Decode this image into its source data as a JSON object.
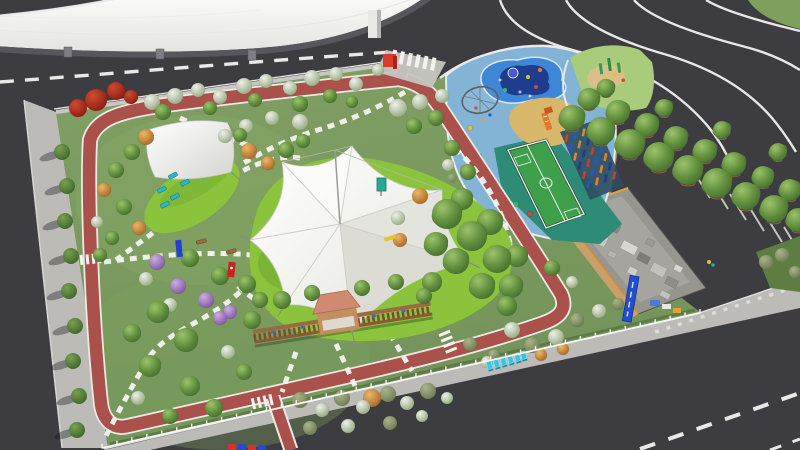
{
  "palette": {
    "asphalt": "#3c3c41",
    "asphalt_light": "#46464b",
    "sidewalk": "#bcbbb7",
    "building_roof": "#f2f2ef",
    "building_shadow": "#56565c",
    "grass_base": "#7a9a5e",
    "lawn_bright": "#8bc43c",
    "track_red": "#a9514a",
    "track_edge": "#eceae6",
    "path_white": "#f4f4f0",
    "canopy_white": "#f4f4f1",
    "playground_pad": "#83b4d6",
    "splash_blue": "#3e86d8",
    "splash_navy": "#1f3d8e",
    "sand": "#d8b76a",
    "court_green": "#3fa04c",
    "court_zone_teal": "#2e8b76",
    "pergola_brown": "#8a5a36",
    "gazebo_roof": "#d08a72",
    "lounger_teal": "#2ab8c8",
    "sign_red": "#d83a2c",
    "sign_blue": "#2050d0",
    "sculpture_cyan": "#33c6e6",
    "fence_white": "#f6f6f3",
    "tree_green": "#55823a",
    "tree_autumn": "#b5742f",
    "tree_bloom": "#a3b690",
    "tree_purple": "#8f68b0",
    "tree_red": "#8c1f12"
  },
  "objects": [
    "curved-roof-building",
    "perimeter-roads",
    "interchange-curves",
    "park-lawn",
    "red-jogging-track",
    "stepping-stone-paths",
    "tensile-star-canopy",
    "shade-sail",
    "lounge-chairs",
    "children-playground",
    "splash-pad",
    "rope-climber",
    "sand-pit-slide",
    "mini-soccer-court",
    "climbing-pillars",
    "pergola-gazebo",
    "tree-rows",
    "parking-stalls",
    "service-building",
    "banner-sign",
    "cyan-text-sculpture",
    "entrance-red-cube",
    "white-fence"
  ],
  "scene": {
    "trees": [
      [
        "red",
        96,
        100,
        11
      ],
      [
        "red",
        116,
        91,
        9
      ],
      [
        "red",
        78,
        108,
        9
      ],
      [
        "red",
        131,
        97,
        7
      ],
      [
        "bloom",
        152,
        102,
        8
      ],
      [
        "bloom",
        175,
        96,
        8
      ],
      [
        "bloom",
        198,
        90,
        7
      ],
      [
        "bloom",
        220,
        97,
        7
      ],
      [
        "bloom",
        244,
        86,
        8
      ],
      [
        "bloom",
        266,
        81,
        7
      ],
      [
        "bloom",
        290,
        88,
        7
      ],
      [
        "bloom",
        312,
        78,
        8
      ],
      [
        "bloom",
        336,
        74,
        7
      ],
      [
        "bloom",
        356,
        84,
        7
      ],
      [
        "bloom",
        378,
        70,
        6
      ],
      [
        "green",
        163,
        112,
        8
      ],
      [
        "green",
        210,
        108,
        7
      ],
      [
        "green",
        255,
        100,
        7
      ],
      [
        "green",
        300,
        104,
        8
      ],
      [
        "green",
        330,
        96,
        7
      ],
      [
        "green",
        352,
        102,
        6
      ],
      [
        "bloom",
        300,
        122,
        8
      ],
      [
        "bloom",
        272,
        118,
        7
      ],
      [
        "bloom",
        246,
        126,
        7
      ],
      [
        "bloom",
        225,
        136,
        7
      ],
      [
        "bloom",
        398,
        108,
        9
      ],
      [
        "bloom",
        420,
        102,
        8
      ],
      [
        "green",
        436,
        118,
        8
      ],
      [
        "green",
        414,
        126,
        8
      ],
      [
        "bloom",
        442,
        96,
        7
      ],
      [
        "autumn",
        146,
        137,
        8
      ],
      [
        "green",
        132,
        152,
        8
      ],
      [
        "green",
        116,
        170,
        8
      ],
      [
        "autumn",
        104,
        190,
        7
      ],
      [
        "green",
        124,
        207,
        8
      ],
      [
        "autumn",
        139,
        228,
        7
      ],
      [
        "green",
        112,
        238,
        7
      ],
      [
        "bloom",
        97,
        222,
        6
      ],
      [
        "green",
        100,
        255,
        7
      ],
      [
        "autumn",
        249,
        151,
        8
      ],
      [
        "autumn",
        268,
        163,
        7
      ],
      [
        "green",
        286,
        150,
        8
      ],
      [
        "green",
        303,
        141,
        7
      ],
      [
        "green",
        240,
        135,
        7
      ],
      [
        "purple",
        157,
        262,
        8
      ],
      [
        "purple",
        178,
        286,
        8
      ],
      [
        "purple",
        206,
        300,
        8
      ],
      [
        "green",
        190,
        258,
        9
      ],
      [
        "green",
        220,
        276,
        9
      ],
      [
        "green",
        247,
        284,
        9
      ],
      [
        "bloom",
        146,
        279,
        7
      ],
      [
        "purple",
        230,
        312,
        7
      ],
      [
        "green",
        260,
        300,
        8
      ],
      [
        "bloom",
        170,
        305,
        7
      ],
      [
        "green",
        158,
        312,
        11
      ],
      [
        "green",
        186,
        340,
        12
      ],
      [
        "green",
        150,
        366,
        11
      ],
      [
        "green",
        190,
        386,
        10
      ],
      [
        "green",
        132,
        333,
        9
      ],
      [
        "purple",
        220,
        318,
        7
      ],
      [
        "bloom",
        228,
        352,
        7
      ],
      [
        "green",
        214,
        408,
        9
      ],
      [
        "green",
        244,
        372,
        8
      ],
      [
        "bloom",
        138,
        398,
        7
      ],
      [
        "green",
        170,
        416,
        8
      ],
      [
        "green",
        252,
        320,
        9
      ],
      [
        "green",
        282,
        300,
        9
      ],
      [
        "green",
        312,
        293,
        8
      ],
      [
        "green",
        362,
        288,
        8
      ],
      [
        "green",
        396,
        282,
        8
      ],
      [
        "green",
        424,
        296,
        8
      ],
      [
        "olive",
        300,
        400,
        8
      ],
      [
        "bloom",
        322,
        410,
        7
      ],
      [
        "olive",
        342,
        398,
        8
      ],
      [
        "bloom",
        363,
        407,
        7
      ],
      [
        "autumn",
        372,
        398,
        9
      ],
      [
        "olive",
        388,
        394,
        8
      ],
      [
        "bloom",
        407,
        403,
        7
      ],
      [
        "olive",
        428,
        391,
        8
      ],
      [
        "bloom",
        447,
        398,
        6
      ],
      [
        "olive",
        310,
        428,
        7
      ],
      [
        "bloom",
        348,
        426,
        7
      ],
      [
        "olive",
        390,
        423,
        7
      ],
      [
        "bloom",
        422,
        416,
        6
      ],
      [
        "green",
        447,
        214,
        15
      ],
      [
        "green",
        472,
        236,
        15
      ],
      [
        "green",
        497,
        259,
        14
      ],
      [
        "green",
        456,
        261,
        13
      ],
      [
        "green",
        482,
        286,
        13
      ],
      [
        "green",
        511,
        286,
        12
      ],
      [
        "green",
        436,
        244,
        12
      ],
      [
        "green",
        462,
        199,
        11
      ],
      [
        "green",
        490,
        222,
        13
      ],
      [
        "green",
        517,
        256,
        11
      ],
      [
        "green",
        432,
        282,
        10
      ],
      [
        "green",
        507,
        306,
        10
      ],
      [
        "autumn",
        420,
        196,
        8
      ],
      [
        "bloom",
        398,
        218,
        7
      ],
      [
        "autumn",
        400,
        240,
        7
      ],
      [
        "green",
        452,
        148,
        8
      ],
      [
        "green",
        468,
        172,
        8
      ],
      [
        "bloom",
        448,
        165,
        6
      ],
      [
        "bloom",
        512,
        330,
        8
      ],
      [
        "olive",
        532,
        345,
        8
      ],
      [
        "bloom",
        556,
        337,
        8
      ],
      [
        "olive",
        577,
        320,
        7
      ],
      [
        "bloom",
        599,
        311,
        7
      ],
      [
        "olive",
        618,
        304,
        6
      ],
      [
        "olive",
        494,
        355,
        6
      ],
      [
        "autumn",
        541,
        355,
        6
      ],
      [
        "olive",
        470,
        344,
        7
      ],
      [
        "bloom",
        487,
        362,
        6
      ],
      [
        "autumn",
        563,
        349,
        6
      ],
      [
        "green",
        552,
        268,
        8
      ],
      [
        "bloom",
        572,
        282,
        6
      ]
    ],
    "row_trees": [
      [
        606,
        88,
        9
      ],
      [
        664,
        108,
        9
      ],
      [
        722,
        130,
        9
      ],
      [
        778,
        152,
        9
      ],
      [
        589,
        99,
        11
      ],
      [
        618,
        112,
        12
      ],
      [
        647,
        125,
        12
      ],
      [
        676,
        138,
        12
      ],
      [
        705,
        151,
        12
      ],
      [
        734,
        164,
        12
      ],
      [
        763,
        177,
        11
      ],
      [
        790,
        190,
        11
      ],
      [
        572,
        118,
        13
      ],
      [
        601,
        131,
        14
      ],
      [
        630,
        144,
        15
      ],
      [
        659,
        157,
        15
      ],
      [
        688,
        170,
        15
      ],
      [
        717,
        183,
        15
      ],
      [
        746,
        196,
        14
      ],
      [
        774,
        209,
        14
      ],
      [
        798,
        220,
        12
      ]
    ],
    "street_trees": [
      [
        62,
        152
      ],
      [
        67,
        186
      ],
      [
        65,
        221
      ],
      [
        71,
        256
      ],
      [
        69,
        291
      ],
      [
        75,
        326
      ],
      [
        73,
        361
      ],
      [
        79,
        396
      ],
      [
        77,
        430
      ]
    ],
    "fence": {
      "x1": 102,
      "y1": 448,
      "x2": 700,
      "y2": 313,
      "posts": 40
    },
    "loungers": {
      "items": [
        [
          168,
          176
        ],
        [
          180,
          183
        ],
        [
          157,
          190
        ],
        [
          170,
          197
        ],
        [
          160,
          205
        ]
      ],
      "w": 9,
      "h": 4,
      "angle": -28
    },
    "benches": [
      [
        196,
        241
      ],
      [
        226,
        251
      ]
    ],
    "play_dots": [
      [
        468,
        142,
        "#d8453a"
      ],
      [
        479,
        156,
        "#3a66d8"
      ],
      [
        463,
        168,
        "#e8a02c"
      ],
      [
        489,
        179,
        "#9a44c8"
      ],
      [
        503,
        192,
        "#2aa8d8"
      ],
      [
        516,
        204,
        "#44b858"
      ],
      [
        530,
        214,
        "#d8453a"
      ],
      [
        470,
        128,
        "#e8c030"
      ]
    ],
    "rock_shrubs": [
      [
        452,
        178
      ],
      [
        462,
        192
      ],
      [
        448,
        206
      ],
      [
        470,
        212
      ],
      [
        456,
        224
      ],
      [
        444,
        190
      ]
    ],
    "splash_dots": [
      [
        528,
        77,
        "#e8c030"
      ],
      [
        536,
        87,
        "#d8453a"
      ],
      [
        505,
        90,
        "#44b858"
      ],
      [
        540,
        70,
        "#e08428"
      ]
    ],
    "climber_dots": [
      [
        476,
        108,
        "#d8453a"
      ],
      [
        490,
        115,
        "#2a53c8"
      ],
      [
        483,
        120,
        "#e8a02c"
      ]
    ],
    "pillar_grid": {
      "ox": 566,
      "oy": 134,
      "cols": 4,
      "rows": 6,
      "ux": 8.6,
      "uy": -2.9,
      "vx": 4.4,
      "vy": 9.2,
      "colors": [
        "#d33b2e",
        "#2a53c8",
        "#e08428",
        "#1e3a8a"
      ]
    },
    "parking_ticks": [
      [
        694,
        172
      ],
      [
        712,
        183
      ],
      [
        730,
        194
      ],
      [
        748,
        205
      ],
      [
        766,
        216
      ],
      [
        784,
        227
      ]
    ],
    "roof_units": [
      [
        596,
        232,
        14,
        10,
        "#c9c8c2"
      ],
      [
        612,
        222,
        10,
        8,
        "#888782"
      ],
      [
        624,
        240,
        16,
        9,
        "#d8d7d1"
      ],
      [
        640,
        252,
        12,
        8,
        "#7e7d78"
      ],
      [
        654,
        262,
        15,
        10,
        "#c2c1bb"
      ],
      [
        668,
        276,
        12,
        8,
        "#8e8d88"
      ],
      [
        610,
        250,
        8,
        6,
        "#b5b4ae"
      ],
      [
        630,
        266,
        9,
        7,
        "#d0cfc9"
      ],
      [
        648,
        238,
        8,
        6,
        "#9a9994"
      ],
      [
        662,
        290,
        10,
        6,
        "#c2c1bb"
      ],
      [
        590,
        220,
        8,
        6,
        "#b0afaa"
      ],
      [
        676,
        264,
        8,
        6,
        "#d8d7d1"
      ]
    ],
    "letters_bottom": [
      [
        228,
        444,
        "#d83030"
      ],
      [
        238,
        444,
        "#2848d0"
      ],
      [
        248,
        445,
        "#d83030"
      ],
      [
        258,
        445,
        "#2848d0"
      ]
    ],
    "cyan_blocks": [
      [
        486,
        362
      ],
      [
        493,
        360
      ],
      [
        500,
        358
      ],
      [
        507,
        356
      ],
      [
        514,
        354
      ],
      [
        520,
        352
      ]
    ]
  }
}
